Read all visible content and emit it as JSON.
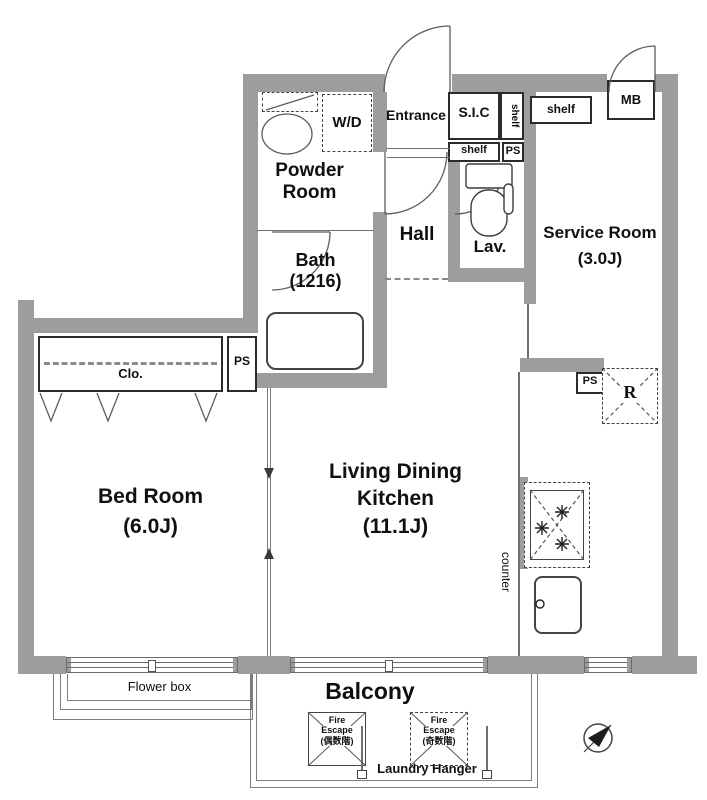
{
  "colors": {
    "wall": "#9d9d9d",
    "line": "#6f6f6f",
    "text": "#101010"
  },
  "labels": {
    "entrance": "Entrance",
    "wd": "W/D",
    "sic": "S.I.C",
    "shelf": "shelf",
    "ps": "PS",
    "mb": "MB",
    "powder1": "Powder",
    "powder2": "Room",
    "hall": "Hall",
    "bath1": "Bath",
    "bath2": "(1216)",
    "lav": "Lav.",
    "service1": "Service Room",
    "service2": "(3.0J)",
    "clo": "Clo.",
    "bed1": "Bed Room",
    "bed2": "(6.0J)",
    "ldk1": "Living Dining",
    "ldk2": "Kitchen",
    "ldk3": "(11.1J)",
    "counter": "counter",
    "r": "R",
    "flower": "Flower box",
    "balcony": "Balcony",
    "fire": "Fire",
    "escape": "Escape",
    "fire_even": "(偶数階)",
    "fire_odd": "(奇数階)",
    "laundry": "Laundry Hanger"
  },
  "rooms": [
    {
      "name": "Bed Room",
      "size": "6.0J"
    },
    {
      "name": "Living Dining Kitchen",
      "size": "11.1J"
    },
    {
      "name": "Service Room",
      "size": "3.0J"
    },
    {
      "name": "Bath",
      "size": "1216"
    },
    {
      "name": "Powder Room",
      "size": ""
    },
    {
      "name": "Hall",
      "size": ""
    },
    {
      "name": "Lav.",
      "size": ""
    },
    {
      "name": "Balcony",
      "size": ""
    }
  ]
}
